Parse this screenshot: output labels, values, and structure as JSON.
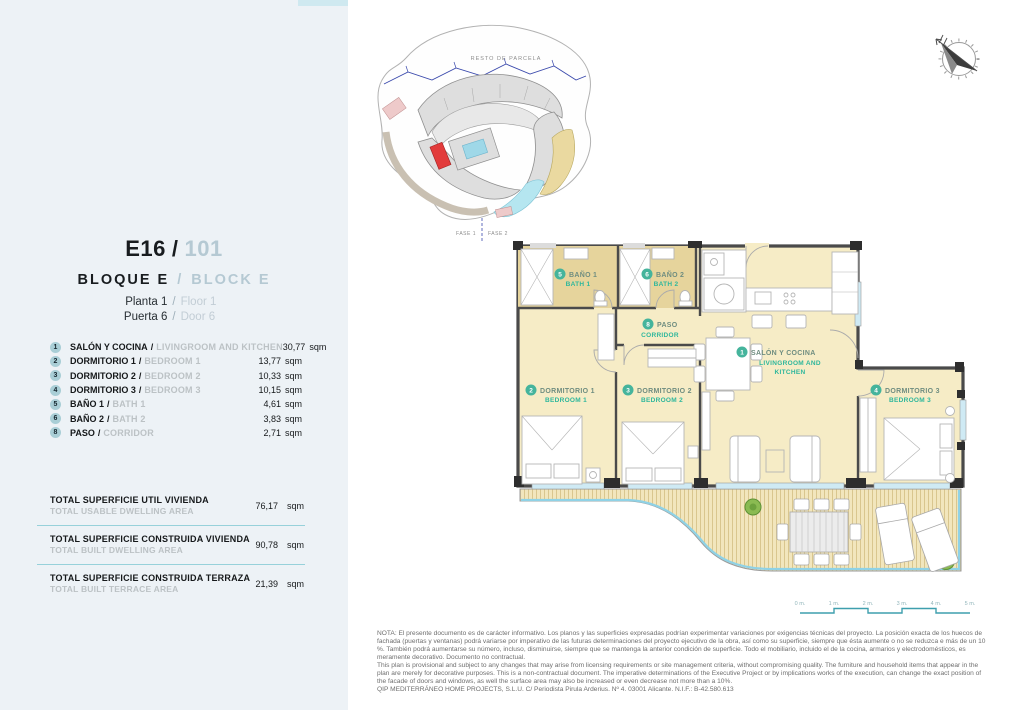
{
  "left_panel": {
    "accent_color": "#cfe9f0",
    "panel_bg": "#edf2f6",
    "separator": "/",
    "unit_code": "E16",
    "unit_number": "101",
    "block_es": "BLOQUE E",
    "block_en": "BLOCK E",
    "floor_es": "Planta 1",
    "floor_en": "Floor 1",
    "door_es": "Puerta 6",
    "door_en": "Door 6",
    "rooms": [
      {
        "num": "1",
        "es": "SALÓN Y COCINA",
        "en": "LIVINGROOM AND KITCHEN",
        "area": "30,77",
        "unit": "sqm"
      },
      {
        "num": "2",
        "es": "DORMITORIO 1",
        "en": "BEDROOM 1",
        "area": "13,77",
        "unit": "sqm"
      },
      {
        "num": "3",
        "es": "DORMITORIO 2",
        "en": "BEDROOM 2",
        "area": "10,33",
        "unit": "sqm"
      },
      {
        "num": "4",
        "es": "DORMITORIO 3",
        "en": "BEDROOM 3",
        "area": "10,15",
        "unit": "sqm"
      },
      {
        "num": "5",
        "es": "BAÑO 1",
        "en": "BATH 1",
        "area": "4,61",
        "unit": "sqm"
      },
      {
        "num": "6",
        "es": "BAÑO 2",
        "en": "BATH 2",
        "area": "3,83",
        "unit": "sqm"
      },
      {
        "num": "8",
        "es": "PASO",
        "en": "CORRIDOR",
        "area": "2,71",
        "unit": "sqm"
      }
    ],
    "totals": [
      {
        "es": "TOTAL SUPERFICIE UTIL VIVIENDA",
        "en": "TOTAL USABLE DWELLING AREA",
        "value": "76,17",
        "unit": "sqm"
      },
      {
        "es": "TOTAL SUPERFICIE CONSTRUIDA VIVIENDA",
        "en": "TOTAL BUILT DWELLING AREA",
        "value": "90,78",
        "unit": "sqm"
      },
      {
        "es": "TOTAL SUPERFICIE CONSTRUIDA TERRAZA",
        "en": "TOTAL BUILT TERRACE AREA",
        "value": "21,39",
        "unit": "sqm"
      }
    ]
  },
  "site_plan": {
    "resto_label": "RESTO DE PARCELA",
    "fase1": "FASE 1",
    "fase2": "FASE 2",
    "highlight_color": "#e23b3b"
  },
  "floor_plan": {
    "room_fill": "#f6ecc6",
    "bath_fill": "#e6d49c",
    "window_blue": "#a8d8e8",
    "label_teal": "#2eb79c",
    "labels": {
      "salon_num": "1",
      "salon_es": "SALÓN Y COCINA",
      "salon_en1": "LIVINGROOM AND",
      "salon_en2": "KITCHEN",
      "dorm1_num": "2",
      "dorm1_es": "DORMITORIO 1",
      "dorm1_en": "BEDROOM 1",
      "dorm2_num": "3",
      "dorm2_es": "DORMITORIO 2",
      "dorm2_en": "BEDROOM 2",
      "dorm3_num": "4",
      "dorm3_es": "DORMITORIO 3",
      "dorm3_en": "BEDROOM 3",
      "bath1_num": "5",
      "bath1_es": "BAÑO 1",
      "bath1_en": "BATH 1",
      "bath2_num": "6",
      "bath2_es": "BAÑO 2",
      "bath2_en": "BATH 2",
      "paso_num": "8",
      "paso_es": "PASO",
      "paso_en": "CORRIDOR"
    },
    "scale_labels": [
      "0 m.",
      "1 m.",
      "2 m.",
      "3 m.",
      "4 m.",
      "5 m."
    ]
  },
  "footer": {
    "nota_es": "NOTA: El presente documento es de carácter informativo. Los planos y las superficies expresadas podrían experimentar variaciones por exigencias técnicas del proyecto. La posición exacta de los huecos de fachada (puertas y ventanas) podrá variarse por imperativo de las futuras determinaciones del proyecto ejecutivo de la obra, así como su superficie, siempre que ésta aumente o no se reduzca e más de un 10 %. También podrá aumentarse su número, incluso, disminuirse, siempre que se mantenga la anterior condición de superficie. Todo el mobiliario, incluido el de la cocina, armarios y electrodomésticos, es meramente decorativo. Documento no contractual.",
    "nota_en": "This plan is provisional and subject to any changes that may arise from licensing requirements or site management criteria, without compromising quality. The furniture and household items that appear in the plan are merely for decorative purposes. This is a non-contractual document. The imperative determinations of the Executive Project or by implications works of the execution, can change the exact position of the facade of doors and windows, as well the surface area may also be increased or even decrease not more than a 10%.",
    "company": "QIP MEDITERRÁNEO HOME PROJECTS, S.L.U. C/ Periodista Pirula Arderius. Nº 4. 03001 Alicante. N.I.F.: B-42.580.613"
  }
}
